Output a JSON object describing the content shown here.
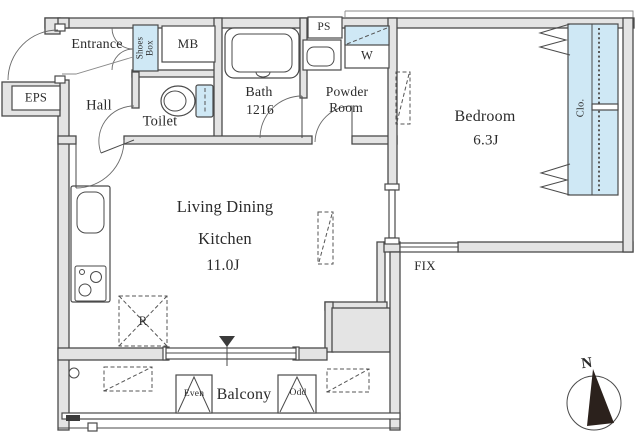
{
  "colors": {
    "wall_fill": "#e4e4e4",
    "line": "#4a4a4a",
    "highlight_blue": "#cfe8f5",
    "text": "#2b2b2b",
    "needle": "#2b211c"
  },
  "rooms": {
    "entrance": {
      "label": "Entrance"
    },
    "shoes_box": {
      "label": "Shoes Box"
    },
    "meter_box": {
      "label": "MB"
    },
    "eps": {
      "label": "EPS"
    },
    "hall": {
      "label": "Hall"
    },
    "toilet": {
      "label": "Toilet"
    },
    "bath": {
      "label": "Bath",
      "size": "1216"
    },
    "pipe_space": {
      "label": "PS"
    },
    "washer": {
      "label": "W"
    },
    "powder_room": {
      "line1": "Powder",
      "line2": "Room"
    },
    "bedroom": {
      "label": "Bedroom",
      "size": "6.3J"
    },
    "closet": {
      "label": "Clo."
    },
    "ldk": {
      "line1": "Living Dining",
      "line2": "Kitchen",
      "size": "11.0J"
    },
    "refrigerator_space": {
      "label": "R"
    },
    "fix_window": {
      "label": "FIX"
    },
    "balcony": {
      "label": "Balcony",
      "hatch_even": "Even",
      "hatch_odd": "Odd"
    },
    "compass": {
      "north": "N"
    }
  }
}
